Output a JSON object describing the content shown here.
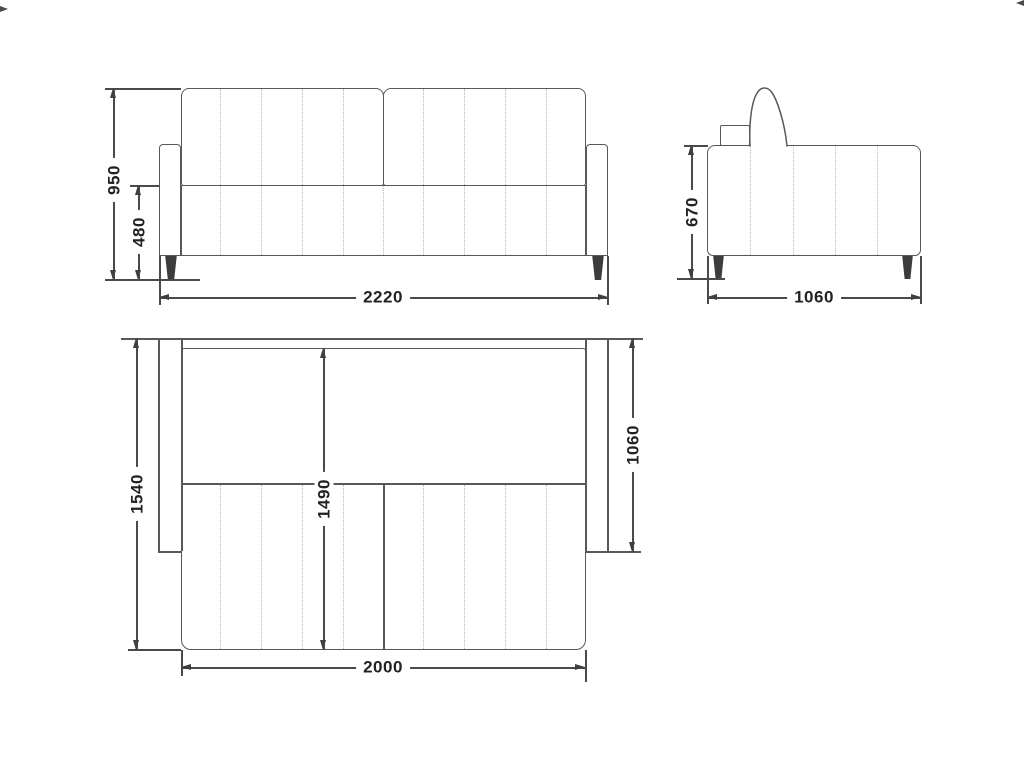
{
  "front_view": {
    "overall_height": "950",
    "seat_height": "480",
    "overall_width": "2220"
  },
  "side_view": {
    "armrest_height": "670",
    "overall_depth": "1060"
  },
  "top_view": {
    "unfolded_depth": "1540",
    "bed_length": "1490",
    "body_depth": "1060",
    "bed_width": "2000"
  },
  "colors": {
    "outline": "#58585a",
    "dimension": "#3f3f41",
    "stitch": "#bdbdbf",
    "leg_fill": "#3d3d40",
    "text": "#222222",
    "background": "#ffffff"
  }
}
